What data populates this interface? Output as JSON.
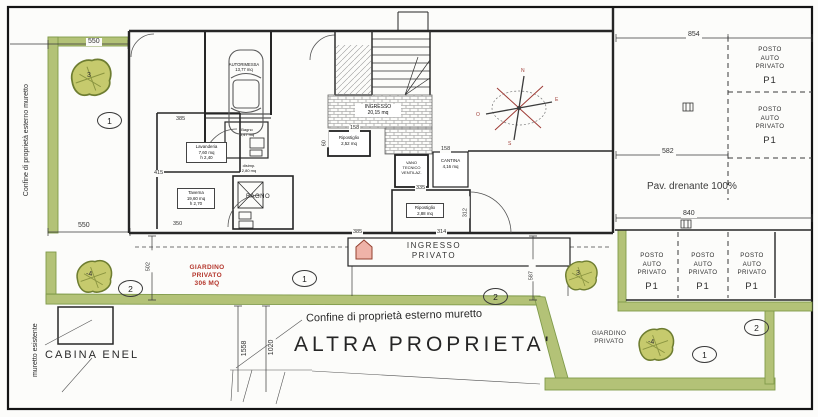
{
  "colors": {
    "boundary_green": "#b3c277",
    "garden_text_red": "#b4362c",
    "entrance_arrow_pink": "#efb3a8",
    "tree_fill": "#c6ca6d"
  },
  "boundary": {
    "left_vertical_label": "Confine di proprietà esterno muretto",
    "bottom_label": "Confine di proprietà esterno muretto",
    "existing_wall_label": "muretto esistente"
  },
  "site": {
    "altra_proprieta": "ALTRA PROPRIETA'",
    "cabina_enel": "CABINA ENEL",
    "pav_drenante": "Pav. drenante 100%",
    "giardino_left": "GIARDINO\nPRIVATO\n306 MQ",
    "giardino_right": "GIARDINO\nPRIVATO",
    "ingresso_privato": "INGRESSO\nPRIVATO"
  },
  "parking": {
    "stall_label": "POSTO\nAUTO\nPRIVATO",
    "stall_code": "P1"
  },
  "rooms": {
    "garage": "AUTORIMESSA\n13,77 mq",
    "bath_small": "Bagno\n3,47 mq",
    "laundry": "Lavanderia\n7,60 mq\nh 2,40",
    "taverna": "Taverna\n19,60 mq\nh 2,70",
    "bagno": "BAGNO",
    "disimpegno": "disimp.\n2,80 mq",
    "hall": "INGRESSO\n20,15 mq",
    "ripostiglio": "Ripostiglio\n2,52 mq",
    "vano_tecnico": "VANO\nTECNICO\nVENTILAZ.",
    "cantina": "CANTINA\n4,16 mq",
    "ripostiglio2": "Ripostiglio\n2,88 mq"
  },
  "dimensions": {
    "top_left": "550",
    "left_bottom": "550",
    "left_vert": "502",
    "top_right": "854",
    "mid_right": "582",
    "lot_bottom": "840",
    "ingresso_left": "385",
    "ingresso_right": "314",
    "south_vert": "587",
    "d1558": "1558",
    "d1020": "1020",
    "room_a": "385",
    "room_a2": "415",
    "room_b": "350",
    "rip_top": "158",
    "cantina_top": "158",
    "room_c": "335",
    "room_c_side": "312",
    "rip_side": "60"
  },
  "markers": {
    "left_garden": "1",
    "left_garden2": "2",
    "mid1": "1",
    "mid2": "2",
    "right_garden1": "1",
    "right_garden2": "2"
  },
  "trees": {
    "left_top": "3",
    "left_bottom": "-4",
    "right_top": "3",
    "right_bottom": "-4"
  },
  "compass": {
    "n": "N",
    "e": "E",
    "s": "S",
    "o": "O"
  }
}
